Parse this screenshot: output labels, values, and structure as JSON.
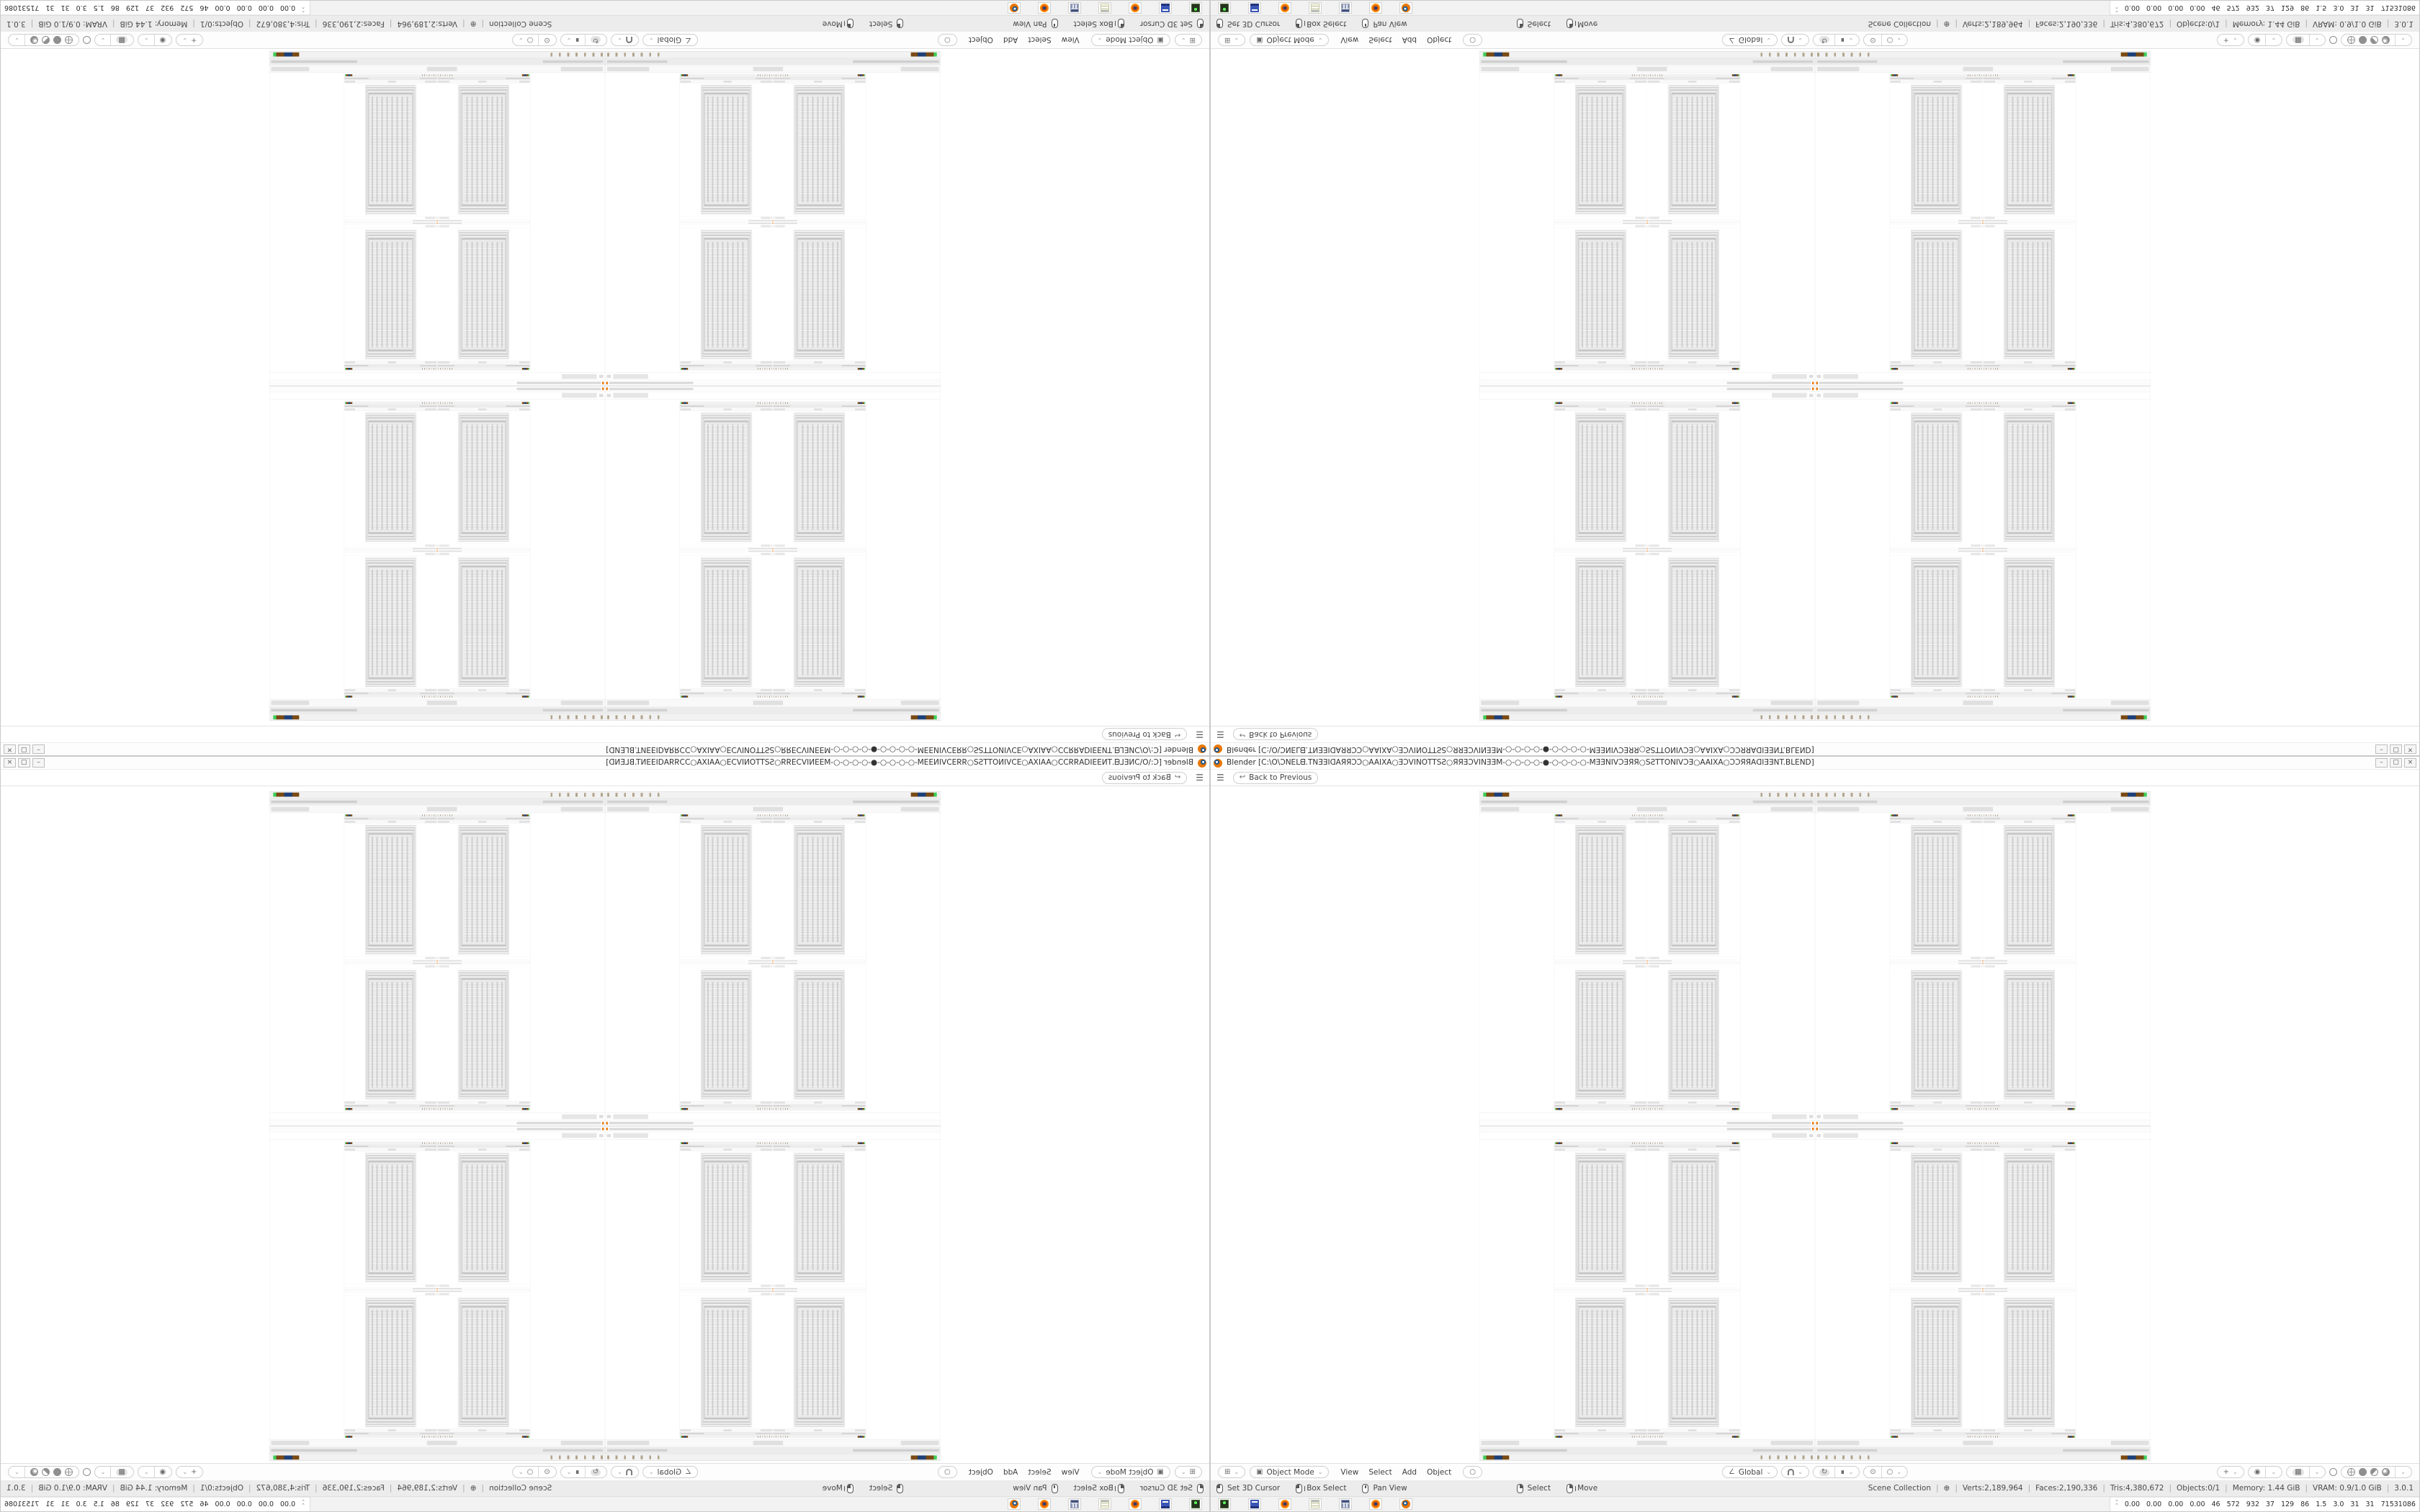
{
  "window": {
    "title": "Blender [C:\\O\\ƆNEᒪᗺ.TNƎƎIᗡAЯЯƆƆ○AAIXA○ƎƆVINOTTSƧ○ЯЯƎƆVINƎƎM-○-○-○-○-●-○-○-○-○-MƎƎNIVƆƎЯЯ○SƧTTONIVƆƎ○AAIXA○ƆƆЯЯAᗡIƎƎNT.BLEND]",
    "controls": {
      "minimize": "–",
      "restore": "▢",
      "close": "×"
    }
  },
  "topbar": {
    "menu_icon": "☰",
    "back_icon": "↩",
    "back_label": "Back to Previous"
  },
  "viewport_header": {
    "editor_icon": "⊞",
    "mode_icon": "▣",
    "mode_label": "Object Mode",
    "menus": [
      "View",
      "Select",
      "Add",
      "Object"
    ],
    "tool_circle": "○",
    "orientation_icon": "∠",
    "orientation_label": "Global",
    "snap_rotate_icon": "↻",
    "snap_pin_icon": "∎",
    "proportional_icon": "⊙",
    "proportional_off_icon": "○",
    "gizmo_icon": "+",
    "overlays_icon": "◉",
    "xray_icon": "▩",
    "chevron": "⌄",
    "shading_modes": [
      "wireframe",
      "solid",
      "material",
      "rendered"
    ],
    "shading_active": "solid"
  },
  "status_bar": {
    "hints": [
      {
        "icon": "mouse-left",
        "label": "Set 3D Cursor"
      },
      {
        "icon": "mouse-left-drag",
        "label": "Box Select"
      },
      {
        "icon": "mouse-middle",
        "label": "Pan View"
      },
      {
        "icon": "mouse-right",
        "label": "Select"
      },
      {
        "icon": "mouse-right-drag",
        "label": "Move"
      }
    ],
    "separator": "|",
    "info": [
      "Scene Collection",
      "⊕",
      "Verts:2,189,964",
      "Faces:2,190,336",
      "Tris:4,380,672",
      "Objects:0/1",
      "Memory: 1.44 GiB",
      "VRAM: 0.9/1.0 GiB",
      "3.0.1"
    ]
  },
  "taskbar": {
    "icons": [
      "system-monitor",
      "commodore-64",
      "firefox",
      "notepad",
      "calculator",
      "firefox",
      "blender"
    ],
    "stats": {
      "chevron": "⌃",
      "values": [
        "0.00",
        "0.00",
        "0.00",
        "0.00",
        "46",
        "572",
        "932",
        "37",
        "129",
        "86",
        "1.5",
        "3.0",
        "31",
        "31",
        "71531086"
      ],
      "bars": [
        {
          "color": "#e9e07a",
          "h": 4,
          "w": 6
        },
        {
          "color": "#e9e07a",
          "h": 3,
          "w": 6
        },
        {
          "color": "#efe9a0",
          "h": 5,
          "w": 10
        },
        {
          "color": "#303030",
          "h": 3,
          "w": 3
        },
        {
          "color": "#e9e07a",
          "h": 4,
          "w": 14
        },
        {
          "color": "#7a4a12",
          "h": 11,
          "w": 22
        },
        {
          "color": "#1d3f77",
          "h": 16,
          "w": 28
        },
        {
          "color": "#7a4a12",
          "h": 14,
          "w": 26
        },
        {
          "color": "#3ecf5a",
          "h": 2,
          "w": 14
        },
        {
          "color": "#3ecf5a",
          "h": 2,
          "w": 12
        }
      ]
    }
  },
  "colors": {
    "blender_orange": "#ea7600",
    "blender_blue": "#265787",
    "chrome_border": "#c9c9c9",
    "status_bg": "#ececec"
  }
}
